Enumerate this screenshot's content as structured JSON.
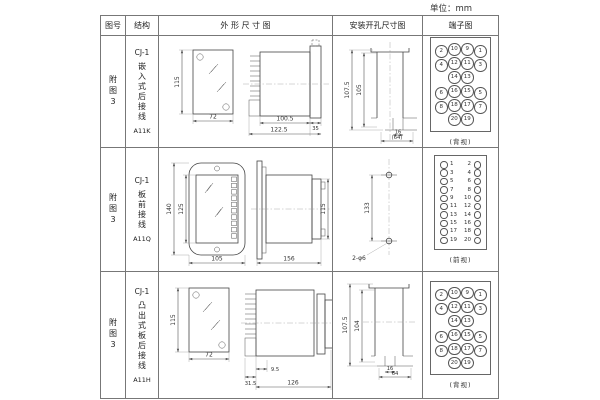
{
  "unit_label": "单位：mm",
  "headers": {
    "figure_no": "图号",
    "structure": "结构",
    "outline": "外 形 尺 寸 图",
    "install": "安装开孔尺寸图",
    "terminal": "端子图"
  },
  "rows": [
    {
      "figure_no": "附图3",
      "structure_model": "CJ-1",
      "structure_desc": "嵌入式后接线",
      "structure_code": "A11K",
      "outline": {
        "front_height": "115",
        "front_width": "72",
        "body_depth": "100.5",
        "total_depth": "122.5",
        "flange": "35"
      },
      "install": {
        "v_outer": "107.5",
        "v_inner": "105",
        "h_inner": "16",
        "h_outer": "(64)"
      },
      "terminal": {
        "cells": [
          "2",
          "10",
          "9",
          "1",
          "4",
          "12",
          "11",
          "3",
          "",
          "14",
          "13",
          "",
          "6",
          "16",
          "15",
          "5",
          "8",
          "18",
          "17",
          "7",
          "",
          "20",
          "19",
          ""
        ],
        "view_label": "(背视)"
      }
    },
    {
      "figure_no": "附图3",
      "structure_model": "CJ-1",
      "structure_desc": "板前接线",
      "structure_code": "A11Q",
      "outline": {
        "front_height_outer": "140",
        "front_height_inner": "125",
        "front_width": "105",
        "depth": "156",
        "side_height": "115"
      },
      "install": {
        "hole_spacing": "133",
        "holes": "2-φ6"
      },
      "terminal": {
        "left": [
          "1",
          "3",
          "5",
          "7",
          "9",
          "11",
          "13",
          "15",
          "17",
          "19"
        ],
        "right": [
          "2",
          "4",
          "6",
          "8",
          "10",
          "12",
          "14",
          "16",
          "18",
          "20"
        ],
        "view_label": "(前视)"
      }
    },
    {
      "figure_no": "附图3",
      "structure_model": "CJ-1",
      "structure_desc": "凸出式板后接线",
      "structure_code": "A11H",
      "outline": {
        "front_height": "115",
        "front_width": "72",
        "stud_depth": "9.5",
        "base_depth": "31.5",
        "total_depth": "126"
      },
      "install": {
        "v_outer": "107.5",
        "v_inner": "104",
        "h_inner": "16",
        "h_outer": "64"
      },
      "terminal": {
        "cells": [
          "2",
          "10",
          "9",
          "1",
          "4",
          "12",
          "11",
          "3",
          "",
          "14",
          "13",
          "",
          "6",
          "16",
          "15",
          "5",
          "8",
          "18",
          "17",
          "7",
          "",
          "20",
          "19",
          ""
        ],
        "view_label": "(背视)"
      }
    }
  ]
}
